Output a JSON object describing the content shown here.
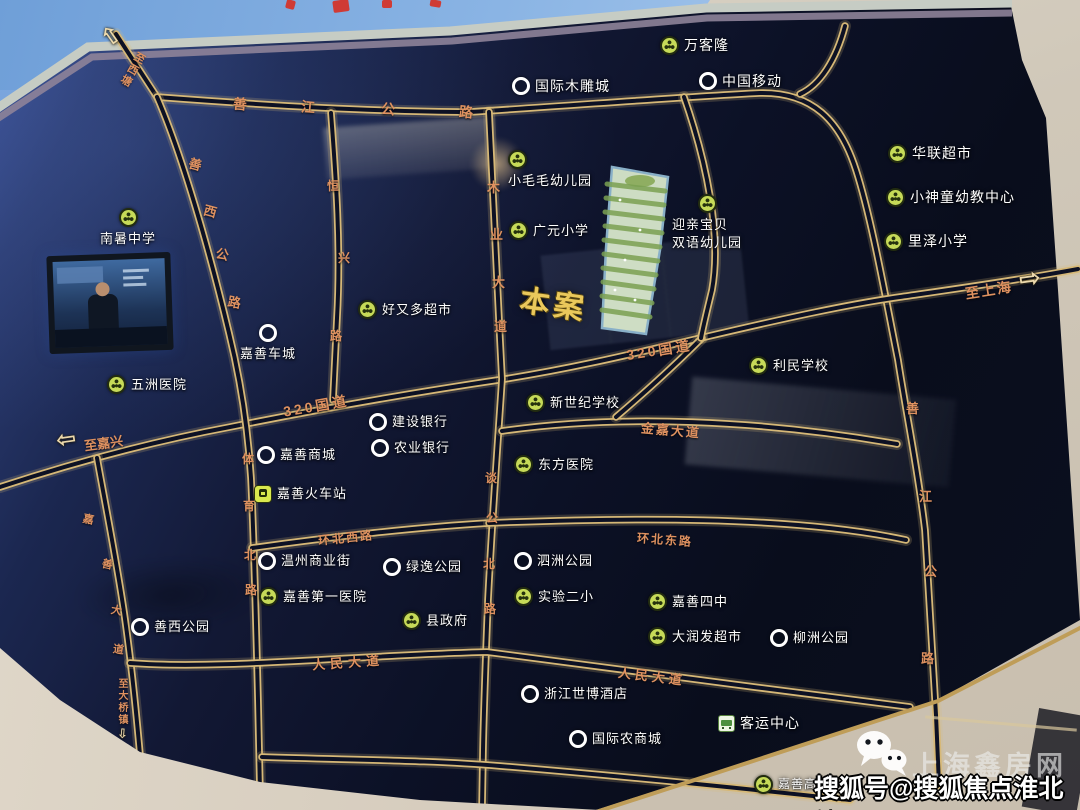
{
  "watermark": {
    "publisher": "上海鑫房网",
    "account_line": "搜狐号@搜狐焦点淮北站"
  },
  "colors": {
    "board_bg": "#0d1228",
    "road_gold": "#d6b877",
    "road_label": "#de9160",
    "poi_text": "#ffffff",
    "poi_green": "#c6da58",
    "accent_gold": "#eac85b",
    "sky": "#85aede",
    "wall": "#d3cabc"
  },
  "map_board": {
    "project_marker": {
      "label": "本案",
      "x": 520,
      "y": 280,
      "rot": 8
    },
    "roads": [
      {
        "id": "shanjiang-highway-loop",
        "d": "M116,34 L157,97 C300,108 400,112 470,112 C580,105 680,97 760,93 C812,92 840,120 856,170 C872,220 886,300 898,360 C906,412 918,470 925,530 C929,590 932,650 936,715 L939,785"
      },
      {
        "id": "320-national-road",
        "d": "M0,487 C70,464 150,442 230,427 C330,407 430,390 505,379 C580,367 640,352 705,337 C790,317 850,304 900,297 C955,289 1020,280 1078,269"
      },
      {
        "id": "jiashan-avenue",
        "d": "M97,458 C106,508 116,558 124,612 C131,660 137,718 142,778 L145,810"
      },
      {
        "id": "shanxi-road-tiyu-north-road",
        "d": "M157,97 C182,155 208,245 229,333 C241,382 248,430 251,478 C254,540 256,620 258,700 L260,792"
      },
      {
        "id": "hengxing-road",
        "d": "M331,113 C336,178 341,248 337,318 L333,400"
      },
      {
        "id": "muye-avenue-tangong-north-road",
        "d": "M489,112 C492,180 496,260 500,340 L502,379 C498,440 492,520 488,600 C486,650 484,700 483,750 L482,808"
      },
      {
        "id": "jinjia-avenue",
        "d": "M502,431 C620,414 760,420 897,444"
      },
      {
        "id": "huanbei-west-road",
        "d": "M252,548 C330,537 420,527 489,523"
      },
      {
        "id": "huanbei-east-road",
        "d": "M489,523 C620,518 790,515 906,540"
      },
      {
        "id": "renmin-avenue",
        "d": "M130,663 C220,670 360,655 487,652 C610,667 770,690 910,707"
      },
      {
        "id": "top-right-diagonal",
        "d": "M845,26 C836,60 820,85 800,94"
      },
      {
        "id": "limin-block-west-edge",
        "d": "M702,338 C672,368 643,394 616,417"
      },
      {
        "id": "site-block-east-edge",
        "d": "M684,97 C706,160 722,235 712,290 C706,315 703,327 701,338"
      },
      {
        "id": "bottom-center-block-edge",
        "d": "M262,757 C350,760 430,760 500,766 C620,776 740,788 850,800"
      }
    ],
    "road_labels": [
      {
        "id": "to-xitang",
        "t": "至西塘",
        "x": 124,
        "y": 50,
        "s": 11,
        "r": 30,
        "v": true
      },
      {
        "t": "善",
        "x": 233,
        "y": 94,
        "s": 14,
        "r": 5
      },
      {
        "t": "江",
        "x": 301,
        "y": 97,
        "s": 14,
        "r": 5
      },
      {
        "t": "公",
        "x": 381,
        "y": 99,
        "s": 14,
        "r": 5
      },
      {
        "t": "路",
        "x": 459,
        "y": 102,
        "s": 14,
        "r": 5
      },
      {
        "t": "善",
        "x": 189,
        "y": 154,
        "s": 13,
        "r": 15
      },
      {
        "t": "西",
        "x": 204,
        "y": 201,
        "s": 13,
        "r": 15
      },
      {
        "t": "公",
        "x": 216,
        "y": 244,
        "s": 13,
        "r": 12
      },
      {
        "t": "路",
        "x": 228,
        "y": 292,
        "s": 13,
        "r": 10
      },
      {
        "t": "恒",
        "x": 327,
        "y": 177,
        "s": 12
      },
      {
        "t": "兴",
        "x": 338,
        "y": 249,
        "s": 12
      },
      {
        "t": "路",
        "x": 330,
        "y": 327,
        "s": 12
      },
      {
        "t": "木",
        "x": 487,
        "y": 177,
        "s": 13
      },
      {
        "t": "业",
        "x": 490,
        "y": 224,
        "s": 13
      },
      {
        "t": "大",
        "x": 492,
        "y": 272,
        "s": 13
      },
      {
        "t": "道",
        "x": 494,
        "y": 316,
        "s": 13
      },
      {
        "id": "320-west",
        "t": "320国道",
        "x": 283,
        "y": 396,
        "s": 14,
        "r": -10,
        "ls": 3
      },
      {
        "id": "320-east",
        "t": "320国道",
        "x": 626,
        "y": 340,
        "s": 14,
        "r": -9,
        "ls": 3
      },
      {
        "id": "to-jiaxing",
        "t": "至嘉兴",
        "x": 84,
        "y": 433,
        "s": 13,
        "r": -8
      },
      {
        "id": "to-shanghai",
        "t": "至上海",
        "x": 965,
        "y": 280,
        "s": 14,
        "r": -9,
        "ls": 2
      },
      {
        "id": "jinjia-avenue",
        "t": "金嘉大道",
        "x": 641,
        "y": 420,
        "s": 13,
        "r": 5,
        "ls": 2
      },
      {
        "t": "体",
        "x": 242,
        "y": 450,
        "s": 12
      },
      {
        "t": "育",
        "x": 243,
        "y": 497,
        "s": 12
      },
      {
        "t": "北",
        "x": 244,
        "y": 546,
        "s": 12
      },
      {
        "t": "路",
        "x": 245,
        "y": 581,
        "s": 12
      },
      {
        "t": "谈",
        "x": 485,
        "y": 469,
        "s": 12
      },
      {
        "t": "公",
        "x": 486,
        "y": 509,
        "s": 12
      },
      {
        "t": "北",
        "x": 483,
        "y": 555,
        "s": 12
      },
      {
        "t": "路",
        "x": 484,
        "y": 600,
        "s": 12
      },
      {
        "id": "huanbei-west",
        "t": "环北西路",
        "x": 318,
        "y": 529,
        "s": 12,
        "r": -6,
        "ls": 2
      },
      {
        "id": "huanbei-east",
        "t": "环北东路",
        "x": 637,
        "y": 531,
        "s": 12,
        "r": 4,
        "ls": 2
      },
      {
        "id": "renmin-west",
        "t": "人民大道",
        "x": 312,
        "y": 652,
        "s": 13,
        "r": -4,
        "ls": 5
      },
      {
        "id": "renmin-east",
        "t": "人民大道",
        "x": 618,
        "y": 666,
        "s": 13,
        "r": 7,
        "ls": 4
      },
      {
        "t": "善",
        "x": 906,
        "y": 398,
        "s": 13
      },
      {
        "t": "江",
        "x": 919,
        "y": 486,
        "s": 13
      },
      {
        "t": "公",
        "x": 924,
        "y": 561,
        "s": 13
      },
      {
        "t": "路",
        "x": 921,
        "y": 648,
        "s": 13
      },
      {
        "t": "嘉",
        "x": 83,
        "y": 511,
        "s": 11,
        "r": 12
      },
      {
        "t": "善",
        "x": 102,
        "y": 556,
        "s": 11,
        "r": 12
      },
      {
        "t": "大",
        "x": 111,
        "y": 602,
        "s": 11,
        "r": 10
      },
      {
        "t": "道",
        "x": 113,
        "y": 641,
        "s": 11,
        "r": 8
      },
      {
        "id": "to-daqiao-town",
        "t": "至大桥镇",
        "x": 114,
        "y": 678,
        "s": 10,
        "v": true
      }
    ],
    "arrows": [
      {
        "id": "arrow-to-xitang",
        "glyph": "⇧",
        "x": 101,
        "y": 24,
        "s": 24,
        "r": -35
      },
      {
        "id": "arrow-to-jiaxing",
        "glyph": "⇦",
        "x": 56,
        "y": 427,
        "s": 24,
        "r": -8
      },
      {
        "id": "arrow-to-shanghai",
        "glyph": "⇨",
        "x": 1019,
        "y": 266,
        "s": 26,
        "r": -8
      },
      {
        "id": "arrow-to-daqiao",
        "glyph": "⇩",
        "x": 117,
        "y": 728,
        "s": 13,
        "r": 5
      }
    ],
    "pois": [
      {
        "id": "wankelong",
        "label": "万客隆",
        "x": 660,
        "y": 36,
        "icon": "green",
        "fs": 14
      },
      {
        "id": "guoji-mudiaocheng",
        "label": "国际木雕城",
        "x": 512,
        "y": 77,
        "icon": "ring",
        "fs": 14
      },
      {
        "id": "zhongguo-yidong",
        "label": "中国移动",
        "x": 699,
        "y": 72,
        "icon": "ring",
        "fs": 14
      },
      {
        "id": "hualian-chaoshi",
        "label": "华联超市",
        "x": 888,
        "y": 144,
        "icon": "green",
        "fs": 14
      },
      {
        "id": "xiaoshentong-youjiao-zhongxin",
        "label": "小神童幼教中心",
        "x": 886,
        "y": 188,
        "icon": "green",
        "fs": 14
      },
      {
        "id": "lize-xiaoxue",
        "label": "里泽小学",
        "x": 884,
        "y": 232,
        "icon": "green",
        "fs": 14
      },
      {
        "id": "nanshu-zhongxue",
        "label": "南暑中学",
        "x": 100,
        "y": 208,
        "icon": "green",
        "fs": 13,
        "layout": "stack"
      },
      {
        "id": "xiaomaomao-youeryuan",
        "label": "小毛毛幼儿园",
        "x": 508,
        "y": 150,
        "icon": "green",
        "fs": 13,
        "layout": "stack",
        "align": "start"
      },
      {
        "id": "guangyuan-xiaoxue",
        "label": "广元小学",
        "x": 509,
        "y": 221,
        "icon": "green",
        "fs": 13
      },
      {
        "id": "yingqin-baobei",
        "label": "迎亲宝贝\n双语幼儿园",
        "x": 672,
        "y": 194,
        "icon": "green",
        "fs": 13,
        "layout": "stack"
      },
      {
        "id": "haoyouduo-chaoshi",
        "label": "好又多超市",
        "x": 358,
        "y": 300,
        "icon": "green",
        "fs": 13
      },
      {
        "id": "jiashan-checheng",
        "label": "嘉善车城",
        "x": 240,
        "y": 324,
        "icon": "ring",
        "fs": 13,
        "layout": "stack"
      },
      {
        "id": "wuzhou-yiyuan",
        "label": "五洲医院",
        "x": 107,
        "y": 375,
        "icon": "green",
        "fs": 13
      },
      {
        "id": "limin-xuexiao",
        "label": "利民学校",
        "x": 749,
        "y": 356,
        "icon": "green",
        "fs": 13
      },
      {
        "id": "xinshiji-xuexiao",
        "label": "新世纪学校",
        "x": 526,
        "y": 393,
        "icon": "green",
        "fs": 13
      },
      {
        "id": "jianshe-yinhang",
        "label": "建设银行",
        "x": 369,
        "y": 413,
        "icon": "ring",
        "fs": 13
      },
      {
        "id": "nongye-yinhang",
        "label": "农业银行",
        "x": 371,
        "y": 439,
        "icon": "ring",
        "fs": 13
      },
      {
        "id": "jiashan-shangcheng",
        "label": "嘉善商城",
        "x": 257,
        "y": 446,
        "icon": "ring",
        "fs": 13
      },
      {
        "id": "jiashan-huochezhan",
        "label": "嘉善火车站",
        "x": 254,
        "y": 485,
        "icon": "train",
        "fs": 13
      },
      {
        "id": "dongfang-yiyuan",
        "label": "东方医院",
        "x": 514,
        "y": 455,
        "icon": "green",
        "fs": 13
      },
      {
        "id": "wenzhou-shangyejie",
        "label": "温州商业街",
        "x": 258,
        "y": 552,
        "icon": "ring",
        "fs": 13
      },
      {
        "id": "lvyi-gongyuan",
        "label": "绿逸公园",
        "x": 383,
        "y": 558,
        "icon": "ring",
        "fs": 13
      },
      {
        "id": "jiashan-diyi-yiyuan",
        "label": "嘉善第一医院",
        "x": 259,
        "y": 587,
        "icon": "green",
        "fs": 13
      },
      {
        "id": "xian-zhengfu",
        "label": "县政府",
        "x": 402,
        "y": 611,
        "icon": "green",
        "fs": 13
      },
      {
        "id": "sizhou-gongyuan",
        "label": "泗洲公园",
        "x": 514,
        "y": 552,
        "icon": "ring",
        "fs": 13
      },
      {
        "id": "shiyan-erxiao",
        "label": "实验二小",
        "x": 514,
        "y": 587,
        "icon": "green",
        "fs": 13
      },
      {
        "id": "jiashan-sizhong",
        "label": "嘉善四中",
        "x": 648,
        "y": 592,
        "icon": "green",
        "fs": 13
      },
      {
        "id": "darunfa-chaoshi",
        "label": "大润发超市",
        "x": 648,
        "y": 627,
        "icon": "green",
        "fs": 13
      },
      {
        "id": "liuzhou-gongyuan",
        "label": "柳洲公园",
        "x": 770,
        "y": 629,
        "icon": "ring",
        "fs": 13
      },
      {
        "id": "shanxi-gongyuan",
        "label": "善西公园",
        "x": 131,
        "y": 618,
        "icon": "ring",
        "fs": 13
      },
      {
        "id": "zhejiang-shibo-jiudian",
        "label": "浙江世博酒店",
        "x": 521,
        "y": 685,
        "icon": "ring",
        "fs": 13
      },
      {
        "id": "keyun-zhongxin",
        "label": "客运中心",
        "x": 718,
        "y": 714,
        "icon": "bus",
        "fs": 14
      },
      {
        "id": "guoji-nongshangcheng",
        "label": "国际农商城",
        "x": 569,
        "y": 730,
        "icon": "ring",
        "fs": 13
      },
      {
        "id": "jiashan-gaotiezhan",
        "label": "嘉善高铁站",
        "x": 754,
        "y": 775,
        "icon": "green",
        "fs": 12
      }
    ]
  }
}
